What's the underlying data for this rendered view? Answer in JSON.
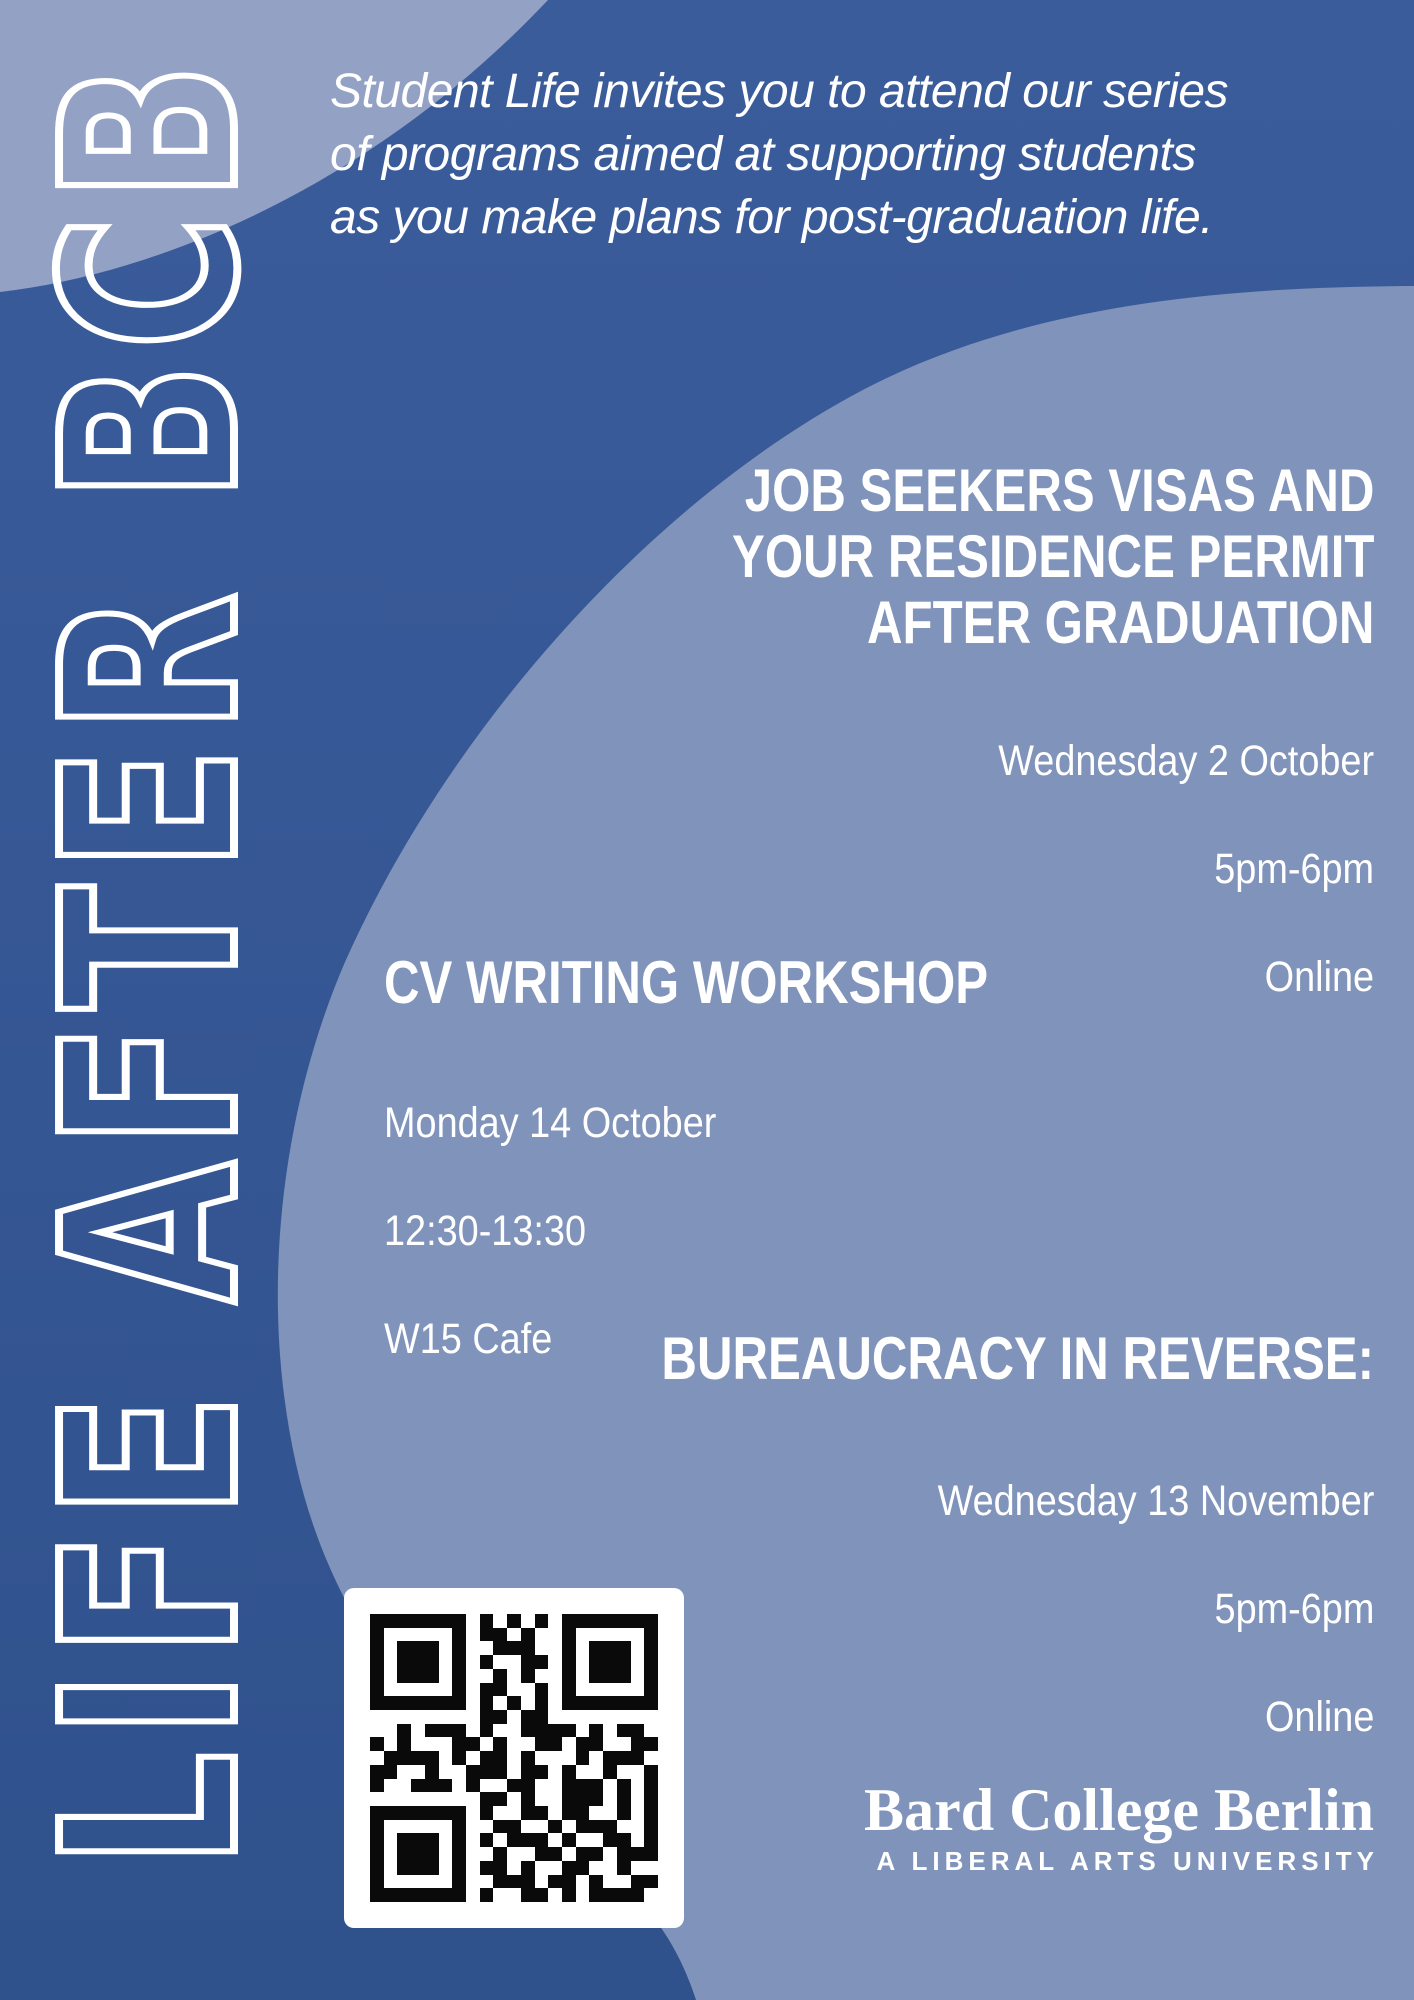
{
  "poster": {
    "vertical_title": "LIFE AFTER BCB",
    "intro": "Student Life invites you to attend our series\nof programs aimed at supporting students\nas you make plans for post-graduation life.",
    "events": [
      {
        "title": "JOB SEEKERS VISAS AND\nYOUR RESIDENCE PERMIT\nAFTER GRADUATION",
        "date": "Wednesday 2 October",
        "time": "5pm-6pm",
        "location": "Online"
      },
      {
        "title": "CV WRITING WORKSHOP",
        "date": "Monday 14 October",
        "time": "12:30-13:30",
        "location": "W15 Cafe"
      },
      {
        "title": "BUREAUCRACY IN REVERSE:",
        "date": "Wednesday 13 November",
        "time": "5pm-6pm",
        "location": "Online"
      }
    ],
    "logo": {
      "name": "Bard College Berlin",
      "tagline": "A LIBERAL ARTS UNIVERSITY"
    },
    "qr": {
      "label": "qr-code",
      "matrix": [
        "#######.#.#.#.#######",
        "#.....#.##.#..#.....#",
        "#.###.#..###..#.###.#",
        "#.###.#.#..##.#.###.#",
        "#.###.#..#.#..#.###.#",
        "#.....#.##..#.#.....#",
        "#######.#.#.#.#######",
        "........##.##........",
        "..#.###.#..####.#.##.",
        "#.#...##.#..##.##..##",
        ".####.#.##.#...#.###.",
        "##..#..###.##.#..#..#",
        "#..###.#..##..###.#.#",
        "........##.#..###.#.#",
        "#######.#..##.##..#.#",
        "#.....#..##..#.###..#",
        "#.###.#.#.###.#..##.#",
        "#.###.#..#..##.##.###",
        "#.###.#.##.#..##..#..",
        "#.....#..###.##.#..##",
        "#######.#..##.#.####."
      ]
    },
    "colors": {
      "background_dark_top": "#3B5C9B",
      "background_dark_bottom": "#2F518C",
      "blob_light": "#8093BA",
      "corner_light": "#93A1C5",
      "text": "#FFFFFF",
      "qr_dark": "#0A0A0A",
      "qr_bg": "#FFFFFF"
    }
  }
}
